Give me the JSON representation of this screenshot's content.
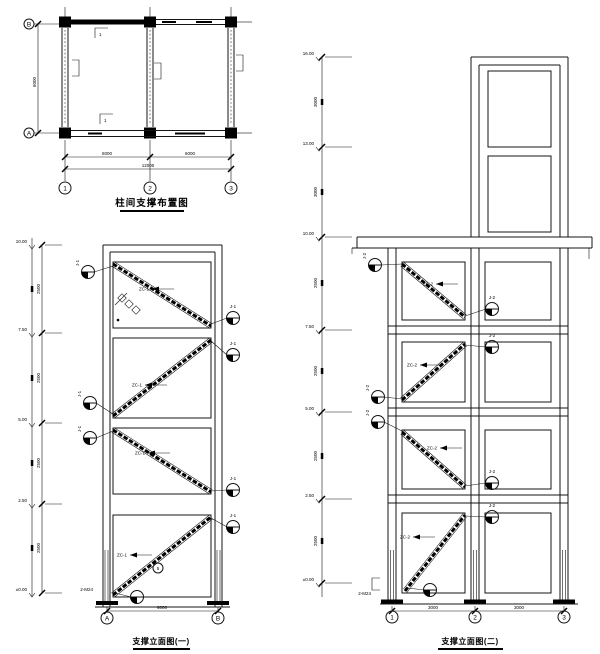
{
  "plan": {
    "title": "柱间支撑布置图",
    "grid_cols": [
      "1",
      "2",
      "3"
    ],
    "grid_row_top": "B",
    "grid_row_bottom": "A",
    "dim_left": "6000",
    "dim_seg1": "6000",
    "dim_seg2": "6000",
    "dim_total": "12000",
    "section_mark_top": "1",
    "section_mark_bottom": "1"
  },
  "left_elevation": {
    "title": "支撑立面图(一)",
    "grid_left": "A",
    "grid_right": "B",
    "dim_bottom": "6000",
    "levels": [
      "10.00",
      "7.50",
      "5.00",
      "2.50",
      "±0.00"
    ],
    "segs": [
      "2500",
      "2500",
      "2500",
      "2500"
    ],
    "brace_tags": [
      "ZC-1",
      "ZC-1",
      "ZC-1",
      "ZC-1"
    ],
    "callout_label": "J-1",
    "anchor_tag": "2-M24",
    "circle_tag": "5"
  },
  "right_elevation": {
    "title": "支撑立面图(二)",
    "grids": [
      "1",
      "2",
      "3"
    ],
    "dim_seg1": "3000",
    "dim_seg2": "3000",
    "levels": [
      "16.00",
      "13.00",
      "10.00",
      "7.50",
      "5.00",
      "2.50",
      "±0.00"
    ],
    "segs": [
      "3000",
      "3000",
      "2500",
      "2500",
      "2500",
      "2500"
    ],
    "brace_tags": [
      "ZC-2",
      "ZC-2",
      "ZC-2",
      "ZC-2"
    ],
    "callout_label": "J-2",
    "anchor_tag": "2-M24"
  }
}
